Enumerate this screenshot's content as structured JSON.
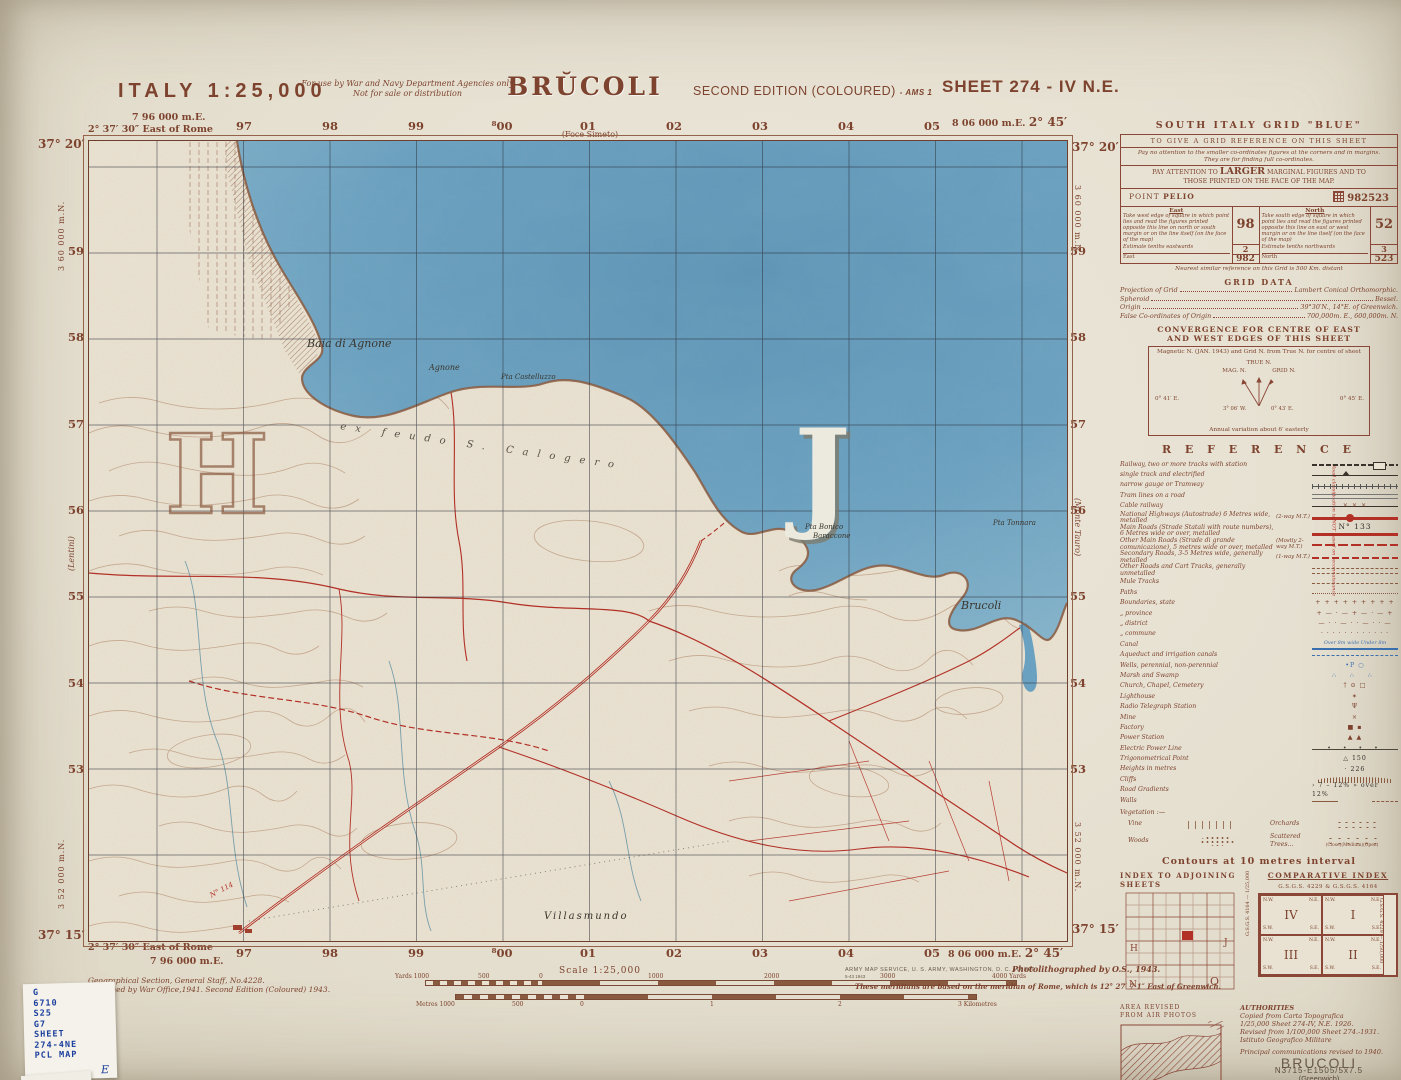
{
  "header": {
    "country_scale": "ITALY  1:25,000",
    "restriction_line1": "For use by War and Navy Department Agencies only",
    "restriction_line2": "Not for sale or distribution",
    "title": "BRŬCOLI",
    "edition": "SECOND EDITION (COLOURED)",
    "edition_suffix": "- AMS 1",
    "sheet": "SHEET 274 - IV N.E."
  },
  "margins": {
    "top_left_easting": "7 96 000 m.E.",
    "left_lon": "2° 37′ 30″ East of Rome",
    "top_left_lat": "37° 20′",
    "top_right_easting": "8 06 000 m.E.",
    "right_lon": "2° 45′",
    "top_right_lat": "37° 20′",
    "bottom_left_lat": "37° 15′",
    "bottom_left_easting": "7 96 000 m.E.",
    "bottom_right_easting": "8 06 000 m.E.",
    "bottom_right_lat": "37° 15′",
    "northing_top": "3 60 000 m.N.",
    "northing_bottom": "3 52 000 m.N.",
    "grid_numbers_top": [
      "97",
      "98",
      "99",
      "⁸00",
      "01",
      "02",
      "03",
      "04",
      "05"
    ],
    "grid_numbers_bottom": [
      "97",
      "98",
      "99",
      "⁸00",
      "01",
      "02",
      "03",
      "04",
      "05"
    ],
    "grid_numbers_left": [
      "59",
      "58",
      "57",
      "56",
      "55",
      "54",
      "53"
    ],
    "grid_numbers_right": [
      "59",
      "58",
      "57",
      "56",
      "55",
      "54",
      "53"
    ],
    "adjoining_top": "(Foce Simeto)",
    "adjoining_bottom": "(Melilli)",
    "adjoining_left": "(Lentini)",
    "adjoining_right": "(Monte Tauro)"
  },
  "map_labels": {
    "bay": "Baia di Agnone",
    "agnone": "Agnone",
    "castelluzzo": "Pta Castelluzzo",
    "bonico": "Pta Bonico",
    "baraccone": "Baraccone",
    "tonnara": "Pta Tonnara",
    "brucoli_town": "Brucoli",
    "villasmundo": "Villasmundo",
    "ex_feudo": "ex feudo S. Calogero",
    "route_number": "N° 114",
    "letter_sea": "J",
    "letter_land": "H"
  },
  "grid_panel": {
    "title": "SOUTH ITALY GRID \"BLUE\"",
    "line1": "TO GIVE A GRID REFERENCE ON THIS SHEET",
    "line2a": "Pay no attention to the smaller co-ordinates figures at the corners and in margins.",
    "line2b": "They are for finding full co-ordinates.",
    "pay_pre": "PAY ATTENTION TO",
    "pay_big": "LARGER",
    "pay_post": "MARGINAL FIGURES AND TO",
    "pay_post2": "THOSE PRINTED ON THE FACE OF THE MAP.",
    "point_label": "POINT",
    "point_name": "PELIO",
    "reference_value": "982523",
    "east_header": "East",
    "east_text": "Take west edge of square in which point lies and read the figures printed opposite this line on north or south margin or on the line itself (on the face of the map)",
    "east_value": "98",
    "east_tenths_label": "Estimate tenths eastwards",
    "east_tenths_value": "2",
    "east_total_label": "East",
    "east_total_value": "982",
    "north_header": "North",
    "north_text": "Take south edge of square in which point lies and read the figures printed opposite this line on east or west margin or on the line itself (on the face of the map)",
    "north_value": "52",
    "north_tenths_label": "Estimate tenths northwards",
    "north_tenths_value": "3",
    "north_total_label": "North",
    "north_total_value": "523",
    "footer": "Nearest similar reference on this Grid is 500 Km. distant"
  },
  "grid_data": {
    "title": "GRID DATA",
    "rows": [
      {
        "label": "Projection of Grid",
        "value": "Lambert Conical Orthomorphic."
      },
      {
        "label": "Spheroid",
        "value": "Bessel."
      },
      {
        "label": "Origin",
        "value": "39°30′N., 14°E. of Greenwich."
      },
      {
        "label": "False Co-ordinates of Origin",
        "value": "700,000m. E., 600,000m. N."
      }
    ]
  },
  "convergence": {
    "title1": "CONVERGENCE FOR CENTRE OF EAST",
    "title2": "AND WEST EDGES OF THIS SHEET",
    "caption": "Magnetic N. (JAN. 1943) and Grid N. from True N. for centre of sheet",
    "true_n": "TRUE N.",
    "mag_n": "MAG. N.",
    "grid_n": "GRID N.",
    "outer_left": "0° 41′ E.",
    "mag_angle": "3° 06′ W.",
    "grid_angle": "0° 43′ E.",
    "outer_right": "0° 45′ E.",
    "footer": "Annual variation about 6′ easterly"
  },
  "legend": {
    "title": "R E F E R E N C E",
    "rows": [
      {
        "label": "Railway, two or more tracks with station",
        "sym": "sym-rail1"
      },
      {
        "label": "single track and electrified",
        "cls": "indent",
        "sym": "sym-rail2"
      },
      {
        "label": "narrow gauge or Tramway",
        "cls": "indent",
        "sym": "sym-rail3"
      },
      {
        "label": "Tram lines on a road",
        "sym": "sym-tram"
      },
      {
        "label": "Cable railway",
        "sym": "sym-cable",
        "symtext": "×     ×     ×"
      },
      {
        "label": "National Highways (Autostrade) 6 Metres wide, metalled",
        "note": "(2-way M.T.)",
        "sym": "sym-autostrada"
      },
      {
        "label": "Main Roads (Strade Statali with route numbers), 6 Metres wide or over, metalled",
        "sym": "sym-mainroad",
        "symtext": "N°   133"
      },
      {
        "label": "Other Main Roads (Strade di grande comunicazione), 5 metres wide or over, metalled",
        "note": "(Mostly 2-way M.T.)",
        "sym": "sym-othermain"
      },
      {
        "label": "Secondary Roads, 3-5 Metres wide, generally metalled",
        "note": "(1-way M.T.)",
        "sym": "sym-secondary"
      },
      {
        "label": "Other Roads and Cart Tracks, generally unmetalled",
        "sym": "sym-cart"
      },
      {
        "label": "Mule Tracks",
        "sym": "sym-mule"
      },
      {
        "label": "Paths",
        "sym": "sym-path"
      },
      {
        "label": "Boundaries, state",
        "symtext": "+ + + + + + + + +"
      },
      {
        "label": "„    province",
        "cls": "indent",
        "symtext": "+ — · — + — · — +"
      },
      {
        "label": "„    district",
        "cls": "indent",
        "symtext": "— · · — · · — · · —"
      },
      {
        "label": "„    commune",
        "cls": "indent",
        "symtext": "· · · · · · · · · · · ·"
      },
      {
        "label": "Canal",
        "sym": "sym-canal",
        "symtext": "Over 8m wide   Under 8m"
      },
      {
        "label": "Aqueduct and irrigation canals",
        "sym": "sym-aqueduct"
      },
      {
        "label": "Wells, perennial, non-perennial",
        "sym": "sym-wells",
        "symtext": "•P        ○"
      },
      {
        "label": "Marsh and Swamp",
        "sym": "sym-marsh",
        "symtext": "∴  ∴  ∴"
      },
      {
        "label": "Church, Chapel, Cemetery",
        "symtext": "†    ⊙    □"
      },
      {
        "label": "Lighthouse",
        "symtext": "✶"
      },
      {
        "label": "Radio Telegraph Station",
        "symtext": "Ψ"
      },
      {
        "label": "Mine",
        "symtext": "×"
      },
      {
        "label": "Factory",
        "symtext": "■  ▪"
      },
      {
        "label": "Power Station",
        "symtext": "▲  ▲"
      },
      {
        "label": "Electric Power Line",
        "sym": "sym-powerline",
        "symtext": "•   •   •   •"
      },
      {
        "label": "Trigonometrical Point",
        "sym": "sym-trig",
        "symtext": "△ 150"
      },
      {
        "label": "Heights in metres",
        "sym": "sym-height",
        "symtext": "· 226"
      },
      {
        "label": "Cliffs",
        "sym": "sym-cliffs"
      },
      {
        "label": "Road Gradients",
        "sym": "sym-grad",
        "symtext": "› 7 – 12%   » over 12%"
      },
      {
        "label": "Walls",
        "sym": "sym-walls"
      }
    ],
    "vegetation_label": "Vegetation :—",
    "veg": [
      {
        "label": "Vine",
        "sym": "sym-vine"
      },
      {
        "label": "Orchards",
        "sym": "sym-orchard"
      },
      {
        "label": "Woods",
        "sym": "sym-woods"
      },
      {
        "label": "Scattered Trees...",
        "sym": "sym-scattered",
        "symtext": "(Close)(Medium)(Open)"
      }
    ],
    "road_note": "Road classification is NOT based on reconnaissance",
    "contours_note": "Contours at 10 metres interval"
  },
  "indexes": {
    "adjoining_title": "INDEX TO ADJOINING SHEETS",
    "comparative_title": "COMPARATIVE INDEX",
    "comparative_header": "G.S.G.S. 4229 & G.S.G.S. 4164",
    "corner_nw": "N.W.",
    "corner_ne": "N.E.",
    "corner_sw": "S.W.",
    "corner_se": "S.E.",
    "quadrants": [
      {
        "num": "IV"
      },
      {
        "num": "I"
      },
      {
        "num": "III"
      },
      {
        "num": "II"
      }
    ],
    "side_left": "G.S.G.S. 4164 — 1/25,000",
    "side_right": "G.S.G.S. 4229 — 1/50,000",
    "letter_h": "H",
    "letter_j": "J",
    "letter_n": "N",
    "letter_o": "O",
    "area_revised_line1": "AREA REVISED",
    "area_revised_line2": "FROM AIR PHOTOS"
  },
  "authorities": {
    "title": "AUTHORITIES",
    "line1": "Copied from Carta Topografica",
    "line2": "1/25,000 Sheet   274-IV, N.E. 1926.",
    "line3": "Revised from  1/100,000 Sheet 274.-1931.",
    "line4": "Istituto Geografico Militare",
    "revision": "Principal communications revised to 1940.",
    "name": "BRUCOLI",
    "designation": "N3715-E1505/5x7.5",
    "datum": "(Greenwich)"
  },
  "footer": {
    "gsgs": "Geographical Section, General Staff, No.4228.",
    "published": "Published by War Office,1941.  Second Edition (Coloured) 1943.",
    "wo_code": "W.O./3/43",
    "scale_title": "Scale 1:25,000",
    "yards_labels": [
      "Yards 1000",
      "500",
      "0",
      "1000",
      "2000",
      "3000",
      "4000 Yards"
    ],
    "metres_labels": [
      "Metres 1000",
      "500",
      "0",
      "1",
      "2",
      "3 Kilometres"
    ],
    "ams_line": "ARMY MAP SERVICE, U. S. ARMY, WASHINGTON, D. C.   108947",
    "ams_line2": "5-43                    1943",
    "photo": "Photolithographed by O.S., 1943.",
    "meridian": "These meridians are based on the meridian of Rome, which is 12° 27′ 7·1″ East of Greenwich."
  },
  "catalog_card": {
    "lines": [
      "G",
      "6710",
      "S25",
      "G7",
      "SHEET",
      "274-4NE",
      "PCL MAP"
    ],
    "annotation": "E"
  }
}
